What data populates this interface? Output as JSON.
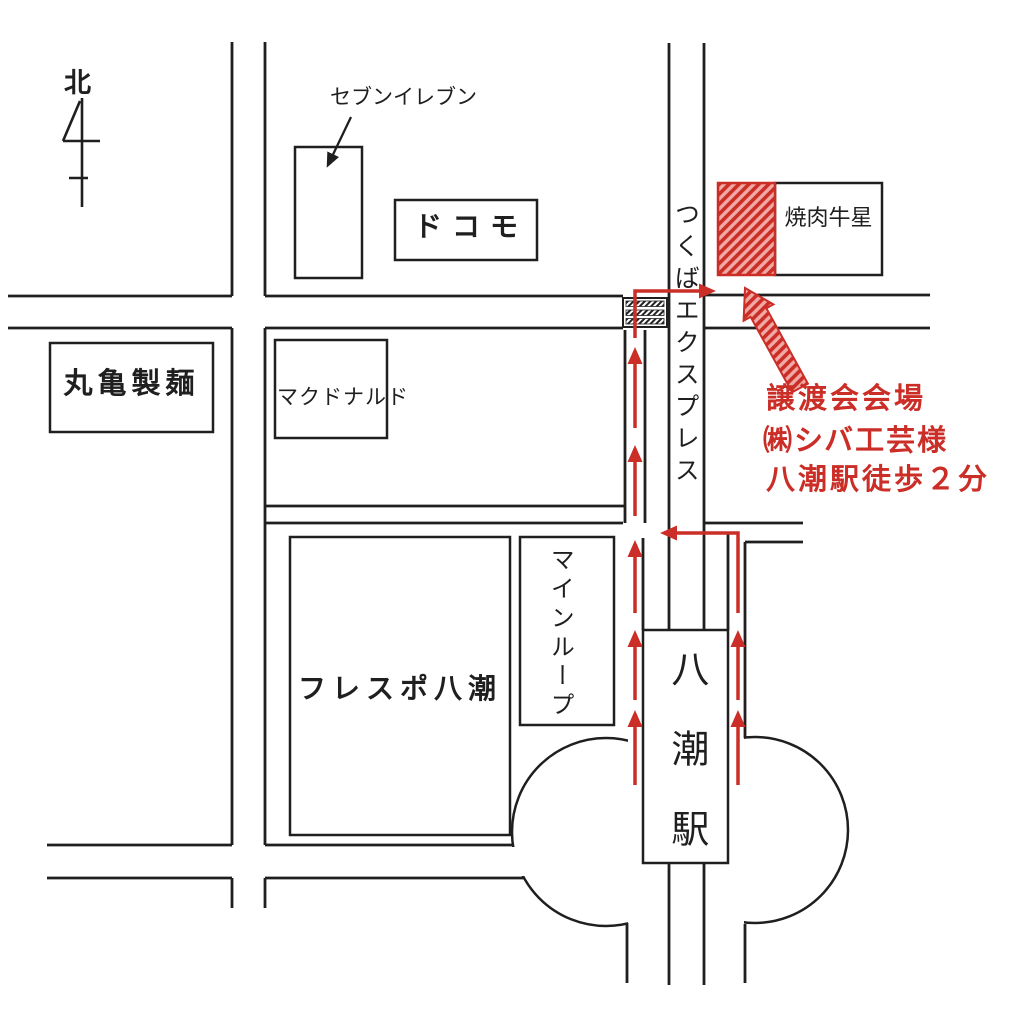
{
  "map_type": "hand-drawn station area guide map",
  "colors": {
    "line": "#1f1f1f",
    "route_red": "#cb2e27",
    "background": "#ffffff"
  },
  "compass": {
    "label": "北"
  },
  "landmarks": {
    "seven_eleven": "セブンイレブン",
    "docomo": "ドコモ",
    "yakiniku": "焼肉牛星",
    "railway": "つくばエクスプレス",
    "marugame": "丸亀製麺",
    "mcdonalds": "マクドナルド",
    "frespo": "フレスポ八潮",
    "mainloop": "マインループ",
    "station": "八潮駅"
  },
  "venue_note": {
    "line1": "譲渡会会場",
    "line2": "㈱シバ工芸様",
    "line3": "八潮駅徒歩２分"
  },
  "icons": {
    "north_arrow": "compass-north-arrow",
    "railroad_crossing": "railroad-crossing-symbol",
    "venue_block": "red-hatched-venue-block",
    "route": "red-route-arrows"
  }
}
